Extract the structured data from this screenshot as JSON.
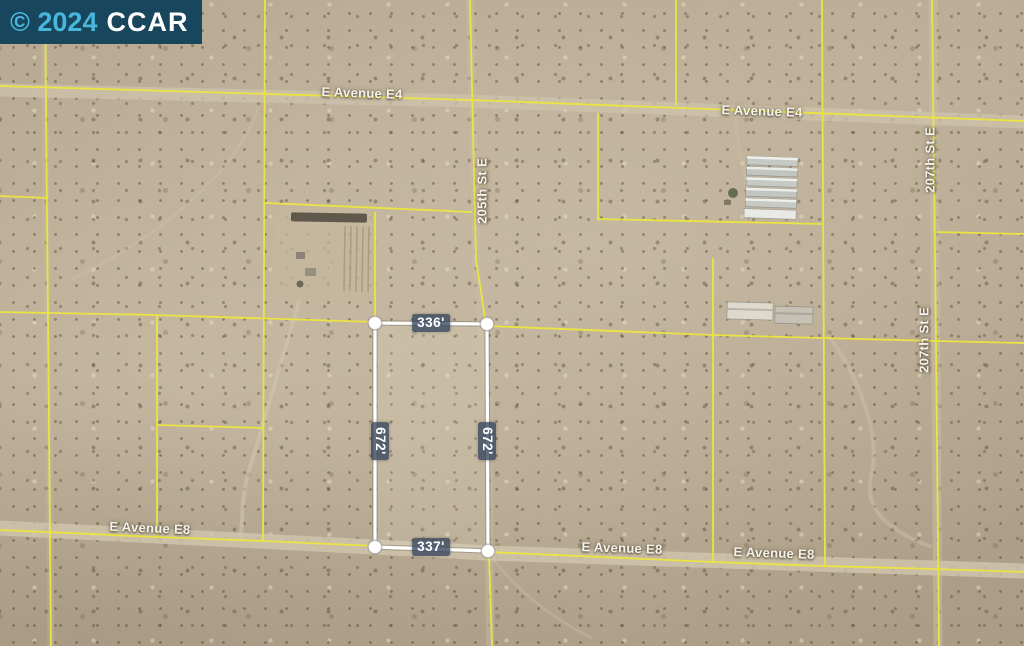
{
  "watermark": {
    "year": "© 2024",
    "org": "CCAR"
  },
  "streets": {
    "labels": [
      {
        "label": "E Avenue E4"
      },
      {
        "label": "E Avenue E4"
      },
      {
        "label": "205th St E"
      },
      {
        "label": "207th St E"
      },
      {
        "label": "207th St E"
      },
      {
        "label": "E Avenue E8"
      },
      {
        "label": "E Avenue E8"
      },
      {
        "label": "E Avenue E8"
      }
    ]
  },
  "parcel": {
    "top_dim": "336'",
    "bottom_dim": "337'",
    "left_dim": "672'",
    "right_dim": "672'"
  },
  "colors": {
    "parcel_grid_line": "#ece73e",
    "subject_outline": "#ffffff",
    "dim_label_bg": "rgba(52,68,94,0.78)",
    "watermark_bg": "#17465d",
    "watermark_year_color": "#49b6dc",
    "watermark_org_color": "#ffffff",
    "terrain_base": "#b3a48d"
  }
}
